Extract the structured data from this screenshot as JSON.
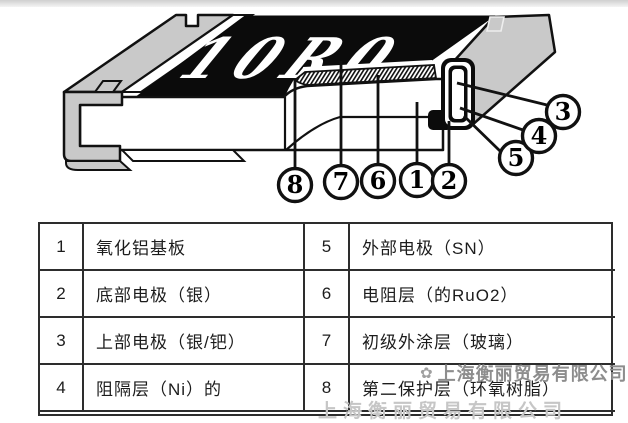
{
  "diagram": {
    "marking": "10R0",
    "callout_labels": {
      "c1": "1",
      "c2": "2",
      "c3": "3",
      "c4": "4",
      "c5": "5",
      "c6": "6",
      "c7": "7",
      "c8": "8"
    }
  },
  "table": {
    "rows": [
      {
        "no_left": "1",
        "desc_left": "氧化铝基板",
        "no_right": "5",
        "desc_right": "外部电极（SN）"
      },
      {
        "no_left": "2",
        "desc_left": "底部电极（银）",
        "no_right": "6",
        "desc_right": "电阻层（的RuO2）"
      },
      {
        "no_left": "3",
        "desc_left": "上部电极（银/钯）",
        "no_right": "7",
        "desc_right": "初级外涂层（玻璃）"
      },
      {
        "no_left": "4",
        "desc_left": "阻隔层（Ni）的",
        "no_right": "8",
        "desc_right": "第二保护层（环氧树脂）"
      }
    ]
  },
  "watermark": {
    "logo_glyph": "✿",
    "company": "上海衡丽贸易有限公司",
    "company_partial": "上海衡丽贸易有限公司"
  },
  "colors": {
    "line": "#111111",
    "body_black": "#0b0b0b",
    "metal_gray": "#c9c9c9",
    "watermark_gray": "#8d8d8d",
    "watermark_faint": "#c6c6c6"
  }
}
